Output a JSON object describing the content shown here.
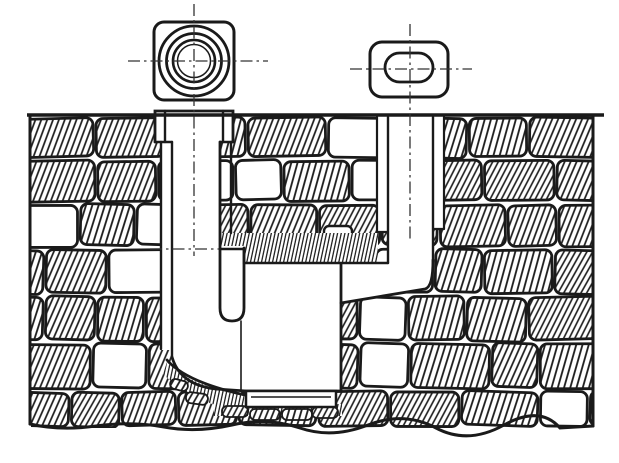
{
  "figure": {
    "description": "Sectional technical drawing of a masonry street gully: round and oval access covers shown in plan above ground line; inlet shaft with stepped collar and hanging dip baffle; sump chamber with base slab on rubble; side channel sloping up to a vertical outlet pipe; surrounding stonework shown with diagonal hatching",
    "type": "line-drawing"
  },
  "colors": {
    "paper": "#ffffff",
    "ink": "#1a1a1a",
    "centerline": "#333333"
  }
}
